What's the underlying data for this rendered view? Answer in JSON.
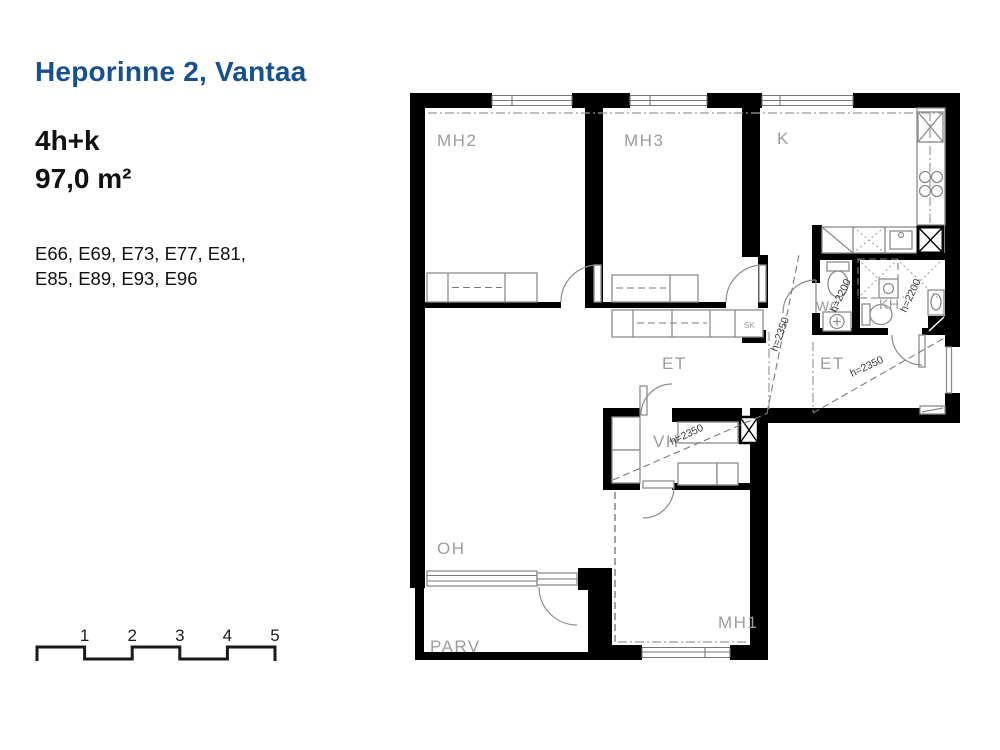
{
  "colors": {
    "title_blue": "#17508f",
    "wall_black": "#000000",
    "furniture_gray": "#8c8c8c",
    "room_label_gray": "#9c9c9c",
    "annotation_gray": "#3a3a3a"
  },
  "info_panel": {
    "title": "Heporinne 2, Vantaa",
    "apartment_type": "4h+k",
    "area": "97,0 m²",
    "apartment_numbers_line1": "E66, E69, E73, E77, E81,",
    "apartment_numbers_line2": "E85, E89, E93, E96"
  },
  "floor_plan": {
    "rooms": [
      {
        "id": "mh2",
        "label": "MH2"
      },
      {
        "id": "mh3",
        "label": "MH3"
      },
      {
        "id": "k",
        "label": "K"
      },
      {
        "id": "wc",
        "label": "WC"
      },
      {
        "id": "kh",
        "label": "KH"
      },
      {
        "id": "et-upper",
        "label": "ET"
      },
      {
        "id": "et-entry",
        "label": "ET"
      },
      {
        "id": "vh",
        "label": "VH"
      },
      {
        "id": "oh",
        "label": "OH"
      },
      {
        "id": "parv",
        "label": "PARV"
      },
      {
        "id": "mh1",
        "label": "MH1"
      },
      {
        "id": "sk-closet",
        "label": "SK"
      }
    ],
    "height_annotations": [
      {
        "id": "vh-height",
        "text": "h=2350"
      },
      {
        "id": "entry-height",
        "text": "h=2350"
      },
      {
        "id": "et-upper-height",
        "text": "h=2350"
      },
      {
        "id": "wc-height",
        "text": "h=2200"
      },
      {
        "id": "kh-height",
        "text": "h=2200"
      }
    ]
  },
  "scale_bar": {
    "ticks": [
      "1",
      "2",
      "3",
      "4",
      "5"
    ]
  }
}
